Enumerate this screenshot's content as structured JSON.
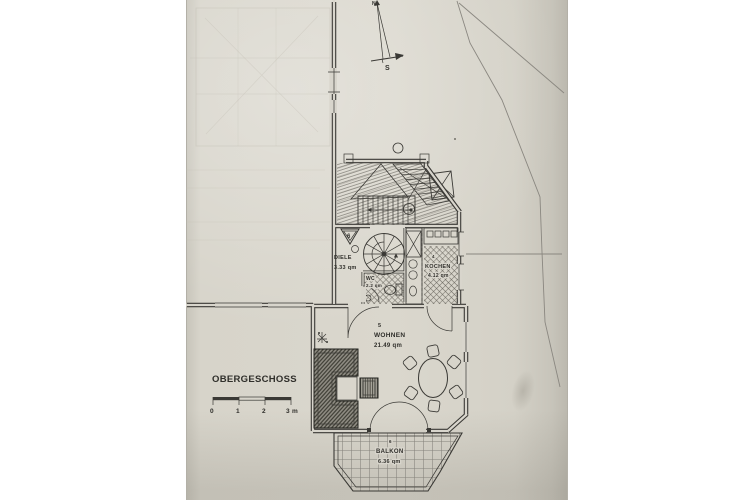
{
  "photo": {
    "paper_color": "#d8d5cc",
    "ink_color": "#3a3935",
    "boundary_color": "#8a8780"
  },
  "title_block": {
    "floor_label": "OBERGESCHOSS"
  },
  "scale_bar": {
    "tick_labels": [
      "0",
      "1",
      "2",
      "3 m"
    ]
  },
  "compass": {
    "north": "N",
    "south": "S"
  },
  "section_marker": {
    "label": "6"
  },
  "rooms": {
    "diele": {
      "name": "DIELE",
      "area": "3.33 qm"
    },
    "wc": {
      "name": "WC",
      "area": "2.2 qm"
    },
    "kochen": {
      "number": "4",
      "name": "KOCHEN",
      "area": "4.12 qm"
    },
    "wohnen": {
      "number": "5",
      "name": "WOHNEN",
      "area": "21.49 qm"
    },
    "balkon": {
      "number": "6",
      "name": "BALKON",
      "area": "6.36 qm"
    }
  }
}
